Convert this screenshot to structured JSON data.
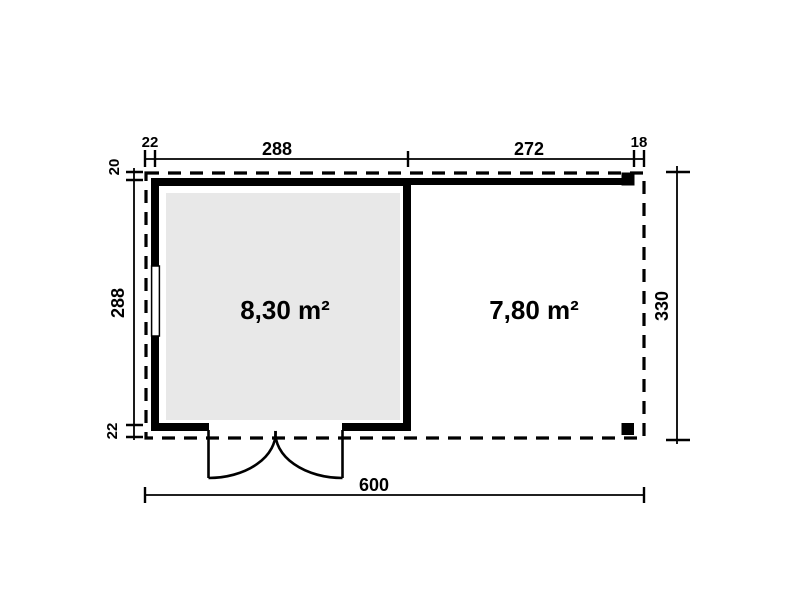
{
  "diagram": {
    "type": "floor-plan",
    "background": "#ffffff",
    "line_color": "#000000",
    "floor_fill": "#e8e8e8",
    "rooms": [
      {
        "id": "cabin",
        "area": "8,30 m²"
      },
      {
        "id": "canopy",
        "area": "7,80 m²"
      }
    ],
    "dimensions": {
      "top": [
        "22",
        "288",
        "272",
        "18"
      ],
      "left": [
        "20",
        "288",
        "22"
      ],
      "right": [
        "330"
      ],
      "bottom": [
        "600"
      ]
    },
    "features": [
      "roof-overhang-outline",
      "double-door",
      "window",
      "front-beam",
      "corner-posts"
    ]
  }
}
